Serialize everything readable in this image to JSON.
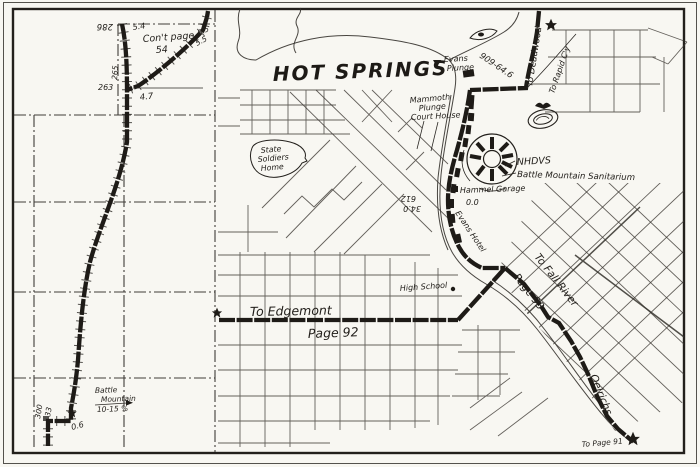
{
  "colors": {
    "paper": "#f8f7f2",
    "ink": "#23201c"
  },
  "title": "HOT SPRINGS",
  "strip": {
    "cont_page_1": "Con't page",
    "cont_page_2": "54",
    "m286": "286",
    "m54": "5.4",
    "m65": "6.5",
    "m55": "5.5",
    "m265": "265",
    "m263": "263",
    "m47": "4.7",
    "m300": "300",
    "m33": "33",
    "m06": "0.6",
    "battle_1": "Battle",
    "battle_2": "Mountain",
    "battle_3": "10-15 %"
  },
  "city": {
    "to_deadwood": "To Deadwood",
    "to_rapid_cy": "To Rapid C'y",
    "m909": "909-64.6",
    "evans_plunge_1": "Evans",
    "evans_plunge_2": "Plunge",
    "mammoth_plunge_1": "Mammoth",
    "mammoth_plunge_2": "Plunge",
    "court_house": "Court House",
    "nhdvs": "NHDVS",
    "sanitarium": "Battle Mountain Sanitarium",
    "soldiers_home_1": "State",
    "soldiers_home_2": "Soldiers",
    "soldiers_home_3": "Home",
    "garage": "Hammel Garage",
    "m00": "0.0",
    "m612": "612",
    "m340": "34.0",
    "evans_hotel": "Evans Hotel",
    "high_school": "High School",
    "to_edgemont": "To Edgemont",
    "page_92": "Page 92",
    "to_fall_river": "To Fall River",
    "page_93": "Page 93",
    "oelrichs": "Oelrichs",
    "to_page_91": "To Page 91"
  }
}
